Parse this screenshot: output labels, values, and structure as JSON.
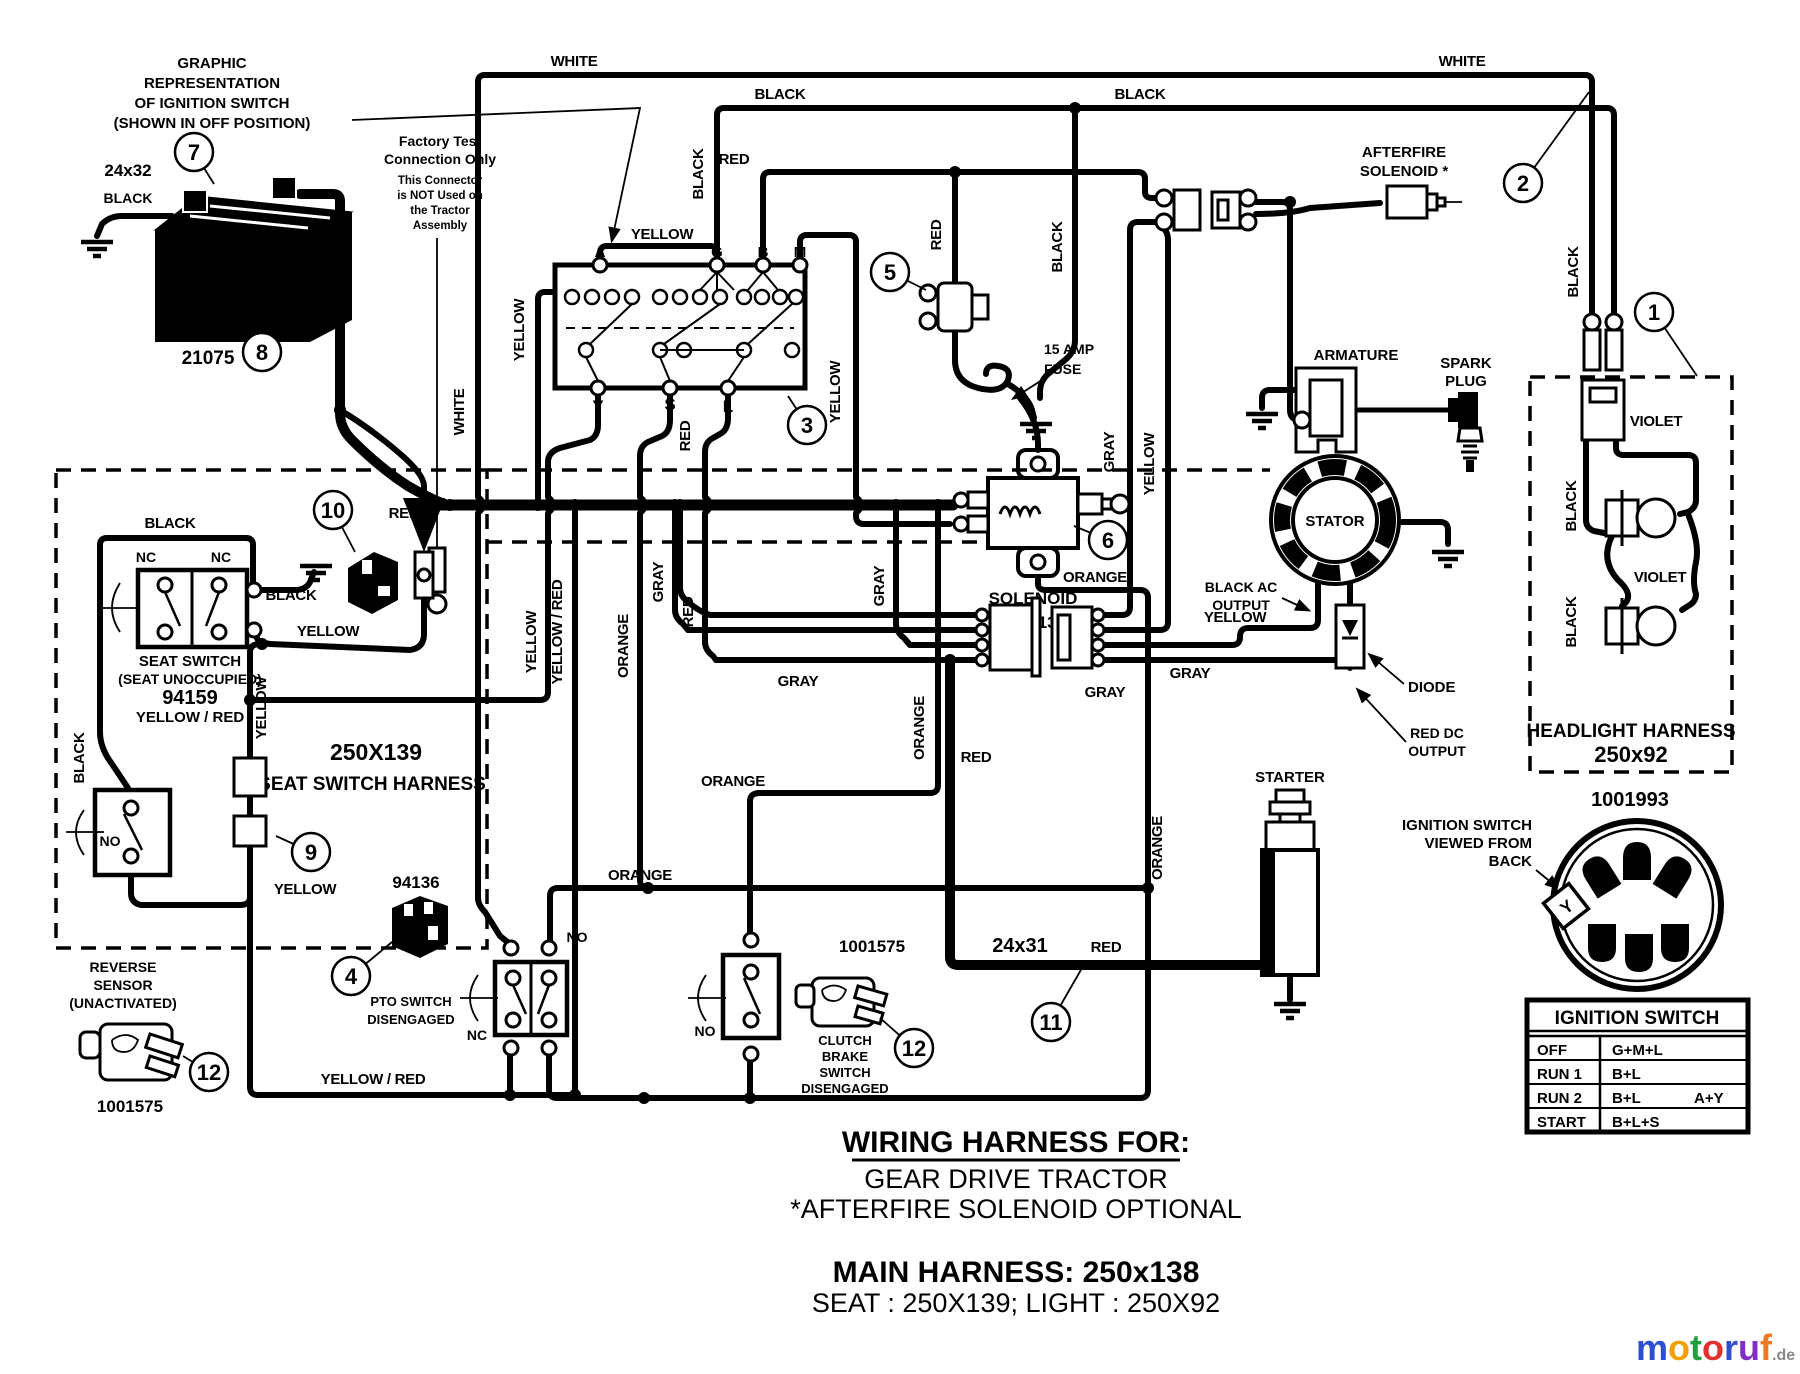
{
  "note_graphic_rep": {
    "l1": "GRAPHIC",
    "l2": "REPRESENTATION",
    "l3": "OF  IGNITION  SWITCH",
    "l4": "(SHOWN  IN  OFF  POSITION)"
  },
  "factory_test": {
    "l1": "Factory Test",
    "l2": "Connection Only",
    "l3": "This Connector",
    "l4": "is NOT Used on",
    "l5": "the Tractor",
    "l6": "Assembly"
  },
  "battery": {
    "name": "BATTERY",
    "part": "21075",
    "cable": "24x32",
    "cable_color": "BLACK"
  },
  "ignition_graphic": {
    "terminals_top": [
      "A",
      "G",
      "B",
      "M"
    ],
    "terminals_bottom": [
      "Y",
      "S",
      "L"
    ]
  },
  "fuse": {
    "l1": "15 AMP",
    "l2": "FUSE"
  },
  "afterfire": {
    "l1": "AFTERFIRE",
    "l2": "SOLENOID *"
  },
  "engine": {
    "armature": "ARMATURE",
    "spark1": "SPARK",
    "spark2": "PLUG",
    "stator": "STATOR",
    "black_ac1": "BLACK AC",
    "black_ac2": "OUTPUT",
    "yellow": "YELLOW",
    "diode": "DIODE",
    "red_dc1": "RED DC",
    "red_dc2": "OUTPUT"
  },
  "solenoid": {
    "name": "SOLENOID",
    "part": "94613"
  },
  "starter": {
    "name": "STARTER",
    "wire": "24x31",
    "wire_color": "RED"
  },
  "headlight": {
    "title": "HEADLIGHT HARNESS",
    "part": "250x92"
  },
  "rotary": {
    "part": "1001993",
    "note1": "IGNITION SWITCH",
    "note2": "VIEWED  FROM",
    "note3": "BACK",
    "terminals": [
      "A",
      "M",
      "S",
      "Y",
      "G",
      "L",
      "B"
    ]
  },
  "table": {
    "title": "IGNITION SWITCH",
    "rows": [
      {
        "pos": "OFF",
        "val": "G+M+L",
        "extra": ""
      },
      {
        "pos": "RUN 1",
        "val": "B+L",
        "extra": ""
      },
      {
        "pos": "RUN 2",
        "val": "B+L",
        "extra": "A+Y"
      },
      {
        "pos": "START",
        "val": "B+L+S",
        "extra": ""
      }
    ]
  },
  "seat": {
    "l1": "SEAT SWITCH",
    "l2": "(SEAT UNOCCUPIED)",
    "part": "94159",
    "l3": "YELLOW / RED",
    "nc1": "NC",
    "nc2": "NC",
    "harness_part": "250X139",
    "harness": "SEAT SWITCH HARNESS"
  },
  "reverse": {
    "l1": "REVERSE",
    "l2": "SENSOR",
    "l3": "(UNACTIVATED)",
    "part": "1001575",
    "no": "NO"
  },
  "pto": {
    "part": "94136",
    "l1": "PTO SWITCH",
    "l2": "DISENGAGED",
    "no": "NO",
    "nc": "NC"
  },
  "clutch": {
    "part": "1001575",
    "l1": "CLUTCH",
    "l2": "BRAKE",
    "l3": "SWITCH",
    "l4": "DISENGAGED",
    "no": "NO"
  },
  "footer": {
    "t1": "WIRING HARNESS FOR:",
    "t2": "GEAR DRIVE TRACTOR",
    "t3": "*AFTERFIRE SOLENOID OPTIONAL",
    "t4": "MAIN HARNESS: 250x138",
    "t5": "SEAT : 250X139;    LIGHT : 250X92"
  },
  "logo": {
    "letters": [
      "m",
      "o",
      "t",
      "o",
      "r",
      "u",
      "f"
    ],
    "colors": [
      "#2b4fd0",
      "#f0a000",
      "#20a040",
      "#e03030",
      "#3050d0",
      "#8030c0",
      "#f07820"
    ],
    "suffix": ".de",
    "suffix_color": "#8a8a8a"
  },
  "callouts": [
    {
      "n": "1",
      "x": 1654,
      "y": 312,
      "lx": 1697,
      "ly": 376
    },
    {
      "n": "2",
      "x": 1523,
      "y": 183,
      "lx": 1589,
      "ly": 92
    },
    {
      "n": "3",
      "x": 807,
      "y": 425,
      "lx": 788,
      "ly": 396
    },
    {
      "n": "4",
      "x": 351,
      "y": 976,
      "lx": 392,
      "ly": 942
    },
    {
      "n": "5",
      "x": 890,
      "y": 272,
      "lx": 926,
      "ly": 290
    },
    {
      "n": "6",
      "x": 1108,
      "y": 540,
      "lx": 1074,
      "ly": 526
    },
    {
      "n": "7",
      "x": 194,
      "y": 152,
      "lx": 214,
      "ly": 184
    },
    {
      "n": "8",
      "x": 262,
      "y": 352,
      "lx": 243,
      "ly": 328
    },
    {
      "n": "9",
      "x": 311,
      "y": 852,
      "lx": 276,
      "ly": 836
    },
    {
      "n": "10",
      "x": 333,
      "y": 510,
      "lx": 355,
      "ly": 552
    },
    {
      "n": "11",
      "x": 1051,
      "y": 1022,
      "lx": 1082,
      "ly": 968
    },
    {
      "n": "12",
      "x": 209,
      "y": 1072,
      "lx": 183,
      "ly": 1056
    },
    {
      "n": "12",
      "x": 914,
      "y": 1048,
      "lx": 880,
      "ly": 1018
    }
  ],
  "wire_labels": [
    {
      "t": "WHITE",
      "x": 574,
      "y": 66
    },
    {
      "t": "BLACK",
      "x": 780,
      "y": 99
    },
    {
      "t": "BLACK",
      "x": 1140,
      "y": 99
    },
    {
      "t": "RED",
      "x": 734,
      "y": 164
    },
    {
      "t": "WHITE",
      "x": 1462,
      "y": 66
    },
    {
      "t": "BLACK",
      "x": 1578,
      "y": 272,
      "r": -90
    },
    {
      "t": "BLACK",
      "x": 1062,
      "y": 247,
      "r": -90
    },
    {
      "t": "YELLOW",
      "x": 662,
      "y": 239
    },
    {
      "t": "BLACK",
      "x": 703,
      "y": 174,
      "r": -90
    },
    {
      "t": "YELLOW",
      "x": 524,
      "y": 330,
      "r": -90
    },
    {
      "t": "WHITE",
      "x": 464,
      "y": 412,
      "r": -90
    },
    {
      "t": "RED",
      "x": 690,
      "y": 436,
      "r": -90
    },
    {
      "t": "YELLOW",
      "x": 840,
      "y": 392,
      "r": -90
    },
    {
      "t": "RED",
      "x": 941,
      "y": 235,
      "r": -90
    },
    {
      "t": "GRAY",
      "x": 884,
      "y": 586,
      "r": -90
    },
    {
      "t": "YELLOW",
      "x": 536,
      "y": 642,
      "r": -90
    },
    {
      "t": "YELLOW / RED",
      "x": 562,
      "y": 632,
      "r": -90
    },
    {
      "t": "ORANGE",
      "x": 628,
      "y": 646,
      "r": -90
    },
    {
      "t": "GRAY",
      "x": 663,
      "y": 582,
      "r": -90
    },
    {
      "t": "RED",
      "x": 693,
      "y": 612,
      "r": -90
    },
    {
      "t": "ORANGE",
      "x": 924,
      "y": 728,
      "r": -90
    },
    {
      "t": "ORANGE",
      "x": 1095,
      "y": 582
    },
    {
      "t": "ORANGE",
      "x": 1162,
      "y": 848,
      "r": -90
    },
    {
      "t": "ORANGE",
      "x": 733,
      "y": 786
    },
    {
      "t": "ORANGE",
      "x": 640,
      "y": 880
    },
    {
      "t": "GRAY",
      "x": 798,
      "y": 686
    },
    {
      "t": "GRAY",
      "x": 1105,
      "y": 697
    },
    {
      "t": "GRAY",
      "x": 1190,
      "y": 678
    },
    {
      "t": "YELLOW",
      "x": 1235,
      "y": 622
    },
    {
      "t": "RED",
      "x": 976,
      "y": 762
    },
    {
      "t": "RED",
      "x": 1106,
      "y": 952
    },
    {
      "t": "GRAY",
      "x": 1114,
      "y": 452,
      "r": -90
    },
    {
      "t": "YELLOW",
      "x": 1154,
      "y": 464,
      "r": -90
    },
    {
      "t": "BLACK",
      "x": 170,
      "y": 528
    },
    {
      "t": "BLACK",
      "x": 291,
      "y": 600
    },
    {
      "t": "YELLOW",
      "x": 328,
      "y": 636
    },
    {
      "t": "RED",
      "x": 404,
      "y": 518
    },
    {
      "t": "YELLOW",
      "x": 266,
      "y": 708,
      "r": -90
    },
    {
      "t": "YELLOW",
      "x": 305,
      "y": 894
    },
    {
      "t": "BLACK",
      "x": 84,
      "y": 758,
      "r": -90
    },
    {
      "t": "YELLOW / RED",
      "x": 373,
      "y": 1084
    },
    {
      "t": "VIOLET",
      "x": 1656,
      "y": 426
    },
    {
      "t": "BLACK",
      "x": 1576,
      "y": 506,
      "r": -90
    },
    {
      "t": "VIOLET",
      "x": 1660,
      "y": 582
    },
    {
      "t": "BLACK",
      "x": 1576,
      "y": 622,
      "r": -90
    }
  ]
}
